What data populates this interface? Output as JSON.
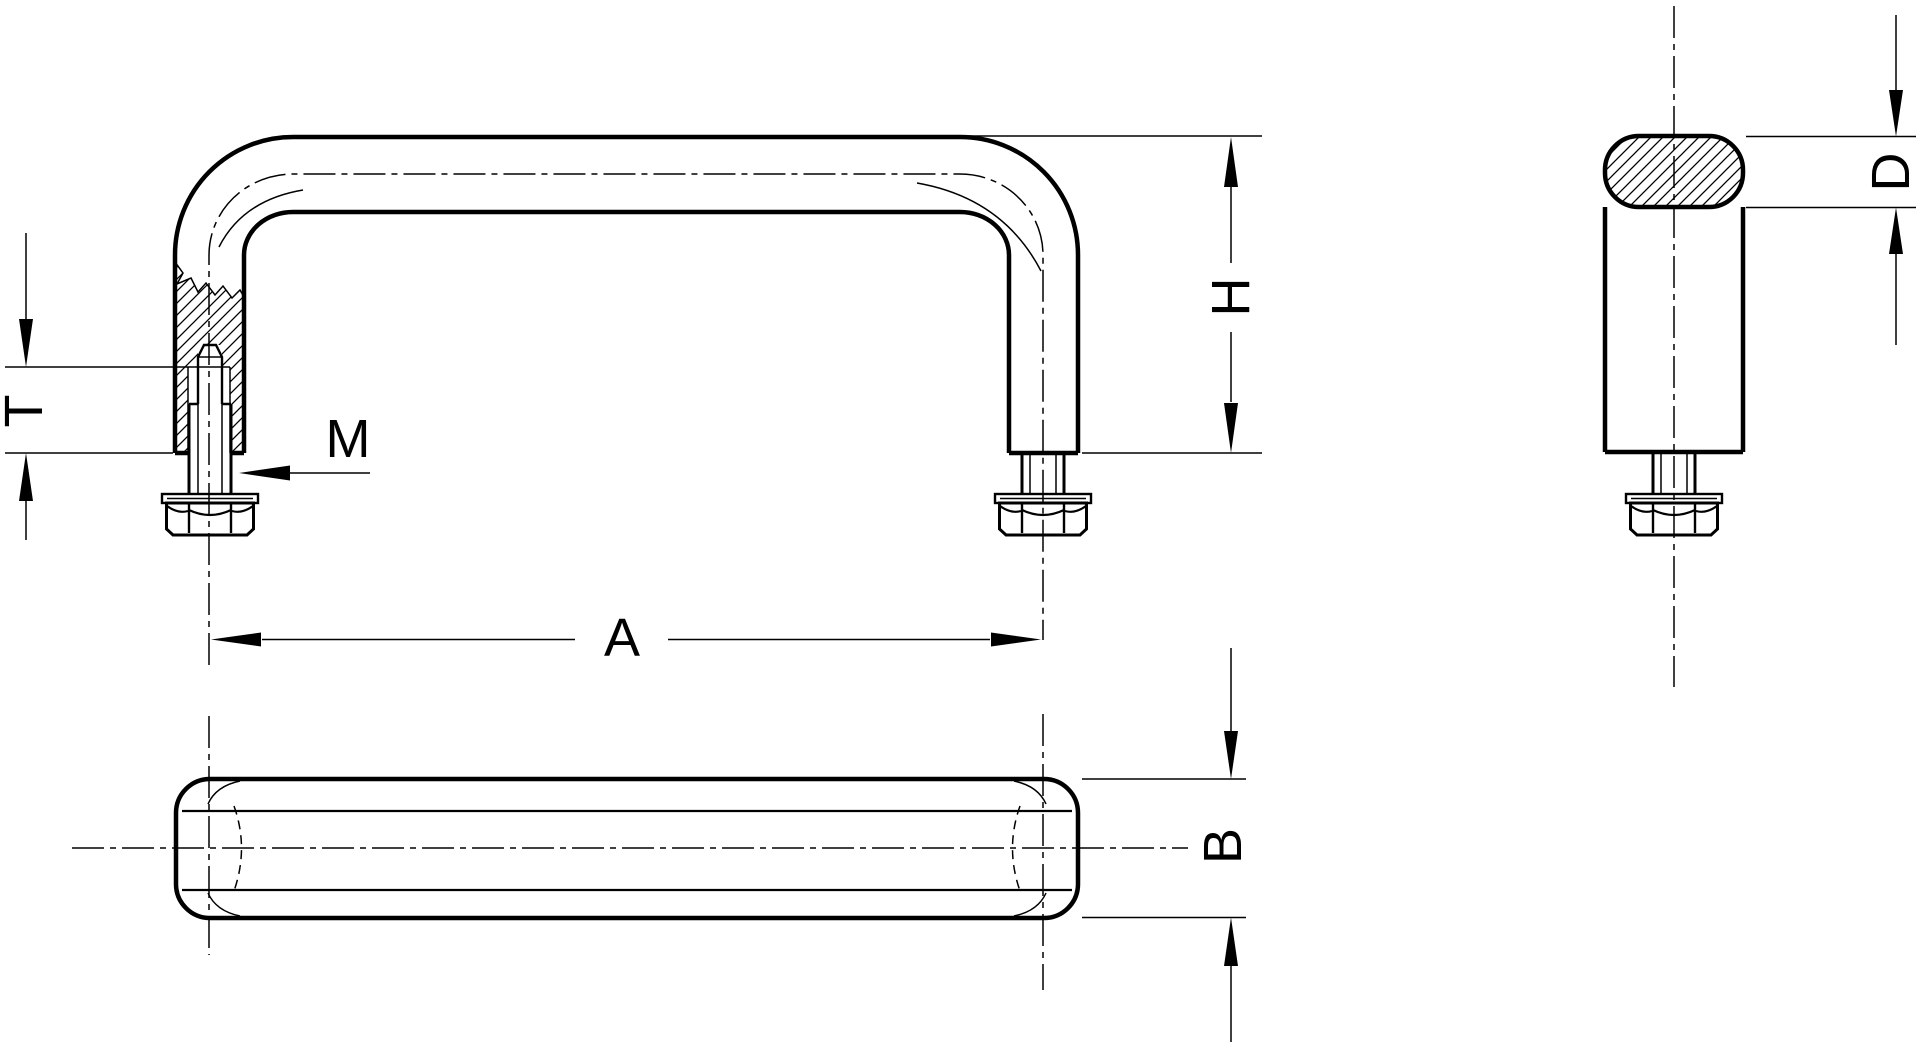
{
  "drawing": {
    "background": "#ffffff",
    "line_color": "#000000",
    "dimension_labels": {
      "hole_distance": "A",
      "grip_depth": "B",
      "tube_diameter": "D",
      "height": "H",
      "thread_size": "M",
      "thread_depth": "T"
    }
  }
}
